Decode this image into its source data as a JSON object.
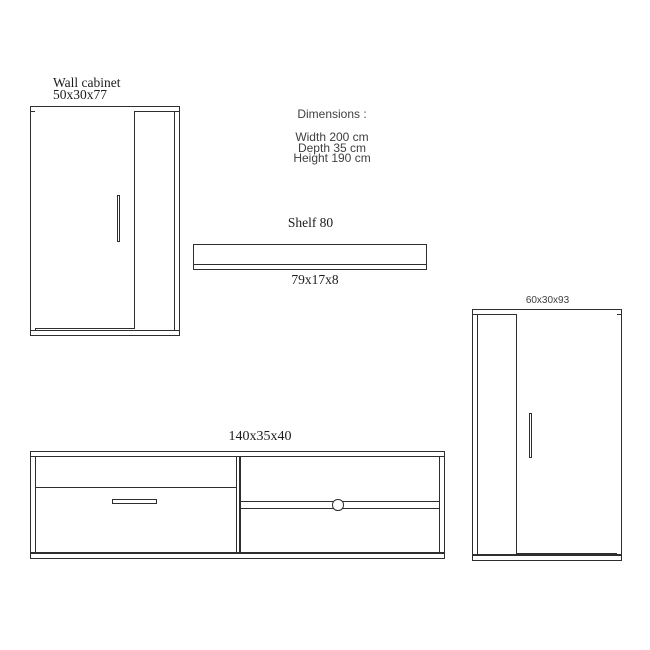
{
  "colors": {
    "background": "#ffffff",
    "line": "#2e2e2e",
    "serif_text": "#1c1c1c",
    "sans_text": "#404040"
  },
  "wall_cabinet": {
    "title": "Wall cabinet",
    "size": "50x30x77"
  },
  "dimensions_panel": {
    "heading": "Dimensions :",
    "width_line": "Width 200 cm",
    "depth_line": "Depth 35 cm",
    "height_line": "Height 190 cm"
  },
  "shelf": {
    "title": "Shelf 80",
    "size": "79x17x8"
  },
  "tall_cabinet": {
    "size": "60x30x93"
  },
  "tv_unit": {
    "size": "140x35x40"
  }
}
